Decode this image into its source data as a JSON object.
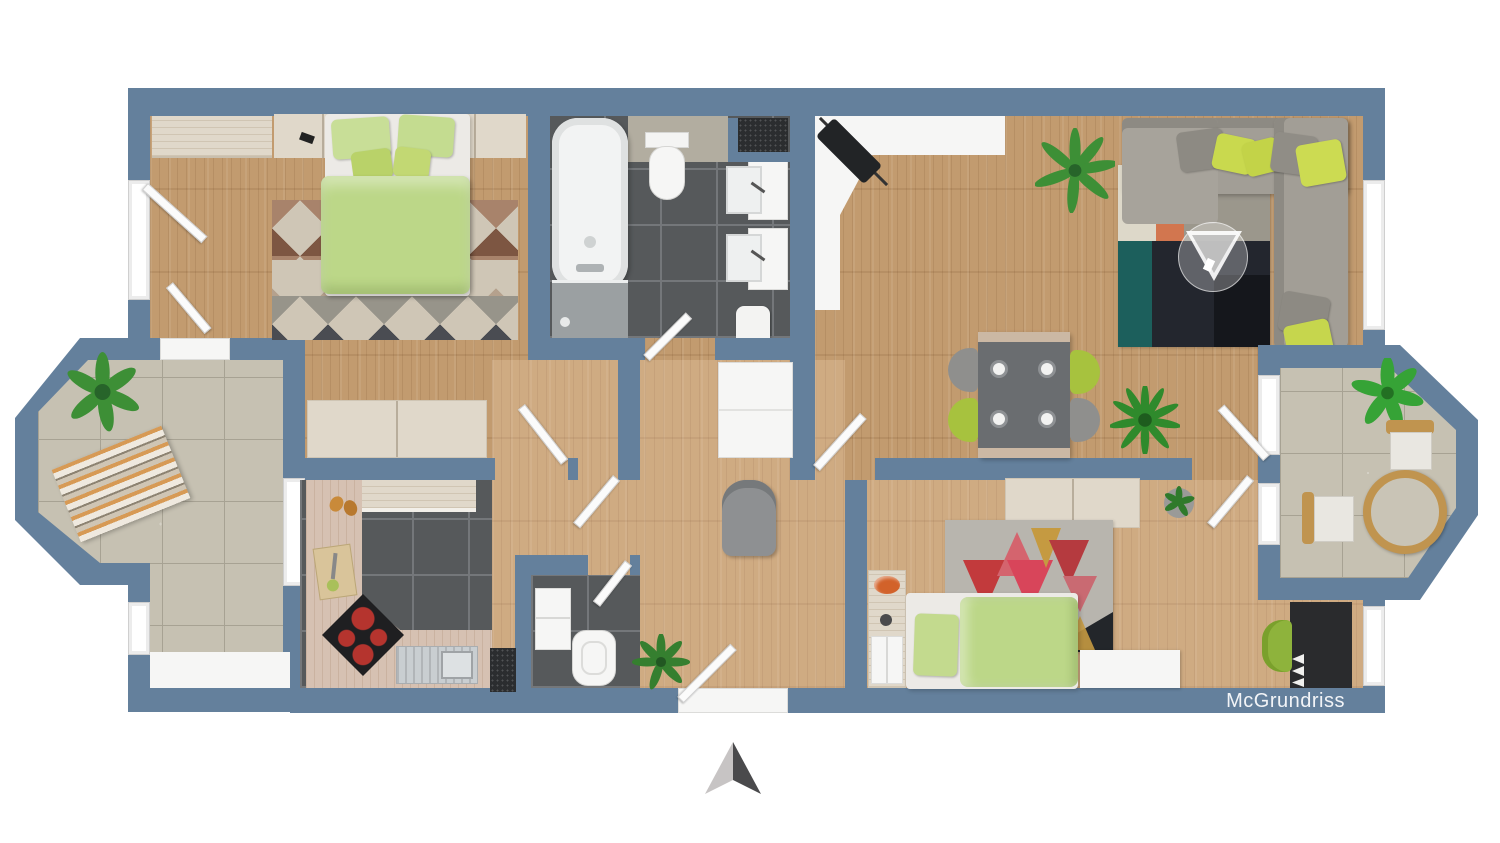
{
  "watermark": {
    "text": "McGrundriss"
  },
  "compass": {
    "icon": "north-arrow-icon"
  },
  "palette": {
    "wall": "#64809c",
    "wood_floor": "#c29b6f",
    "dark_tile": "#56595b",
    "balcony_tile": "#c6c1b2",
    "light_wood": "#e0d8ca",
    "counter_wood": "#d6c1b2",
    "accent_lime": "#c9d94e",
    "duvet_green": "#bcd788",
    "sofa_gray": "#a29e96",
    "rug_navy": "#23262e",
    "rug_orange": "#d2764f",
    "north_arrow_light": "#c7c4c4",
    "north_arrow_dark": "#4a4a4c"
  },
  "rooms": [
    {
      "id": "bedroom"
    },
    {
      "id": "bathroom"
    },
    {
      "id": "living-dining-room"
    },
    {
      "id": "kitchen"
    },
    {
      "id": "wc"
    },
    {
      "id": "hallway"
    },
    {
      "id": "kids-room"
    },
    {
      "id": "balcony-left"
    },
    {
      "id": "balcony-right"
    }
  ]
}
